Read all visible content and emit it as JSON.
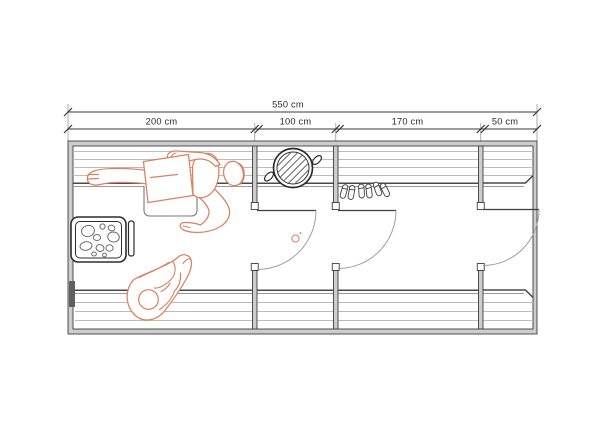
{
  "drawing": {
    "type": "architectural floor plan (sauna)",
    "dimensions": {
      "total": {
        "label": "550 cm"
      },
      "segments": [
        {
          "label": "200 cm"
        },
        {
          "label": "100 cm"
        },
        {
          "label": "170 cm"
        },
        {
          "label": "50 cm"
        }
      ]
    },
    "fixtures": [
      "sauna-heater-with-stones-icon",
      "heater-guard-rail-icon",
      "wash-basin-icon",
      "floor-drain-icon",
      "slippers-icon",
      "person-lying-figure",
      "person-seated-figure",
      "door-swing-arc (x3)",
      "slatted-benches"
    ],
    "colors": {
      "figure_accent": "#d9825f",
      "wall_line": "#3f3f3f",
      "wall_fill": "#cdcdcd",
      "slat_line": "#bcbcbc",
      "background": "#ffffff"
    }
  }
}
